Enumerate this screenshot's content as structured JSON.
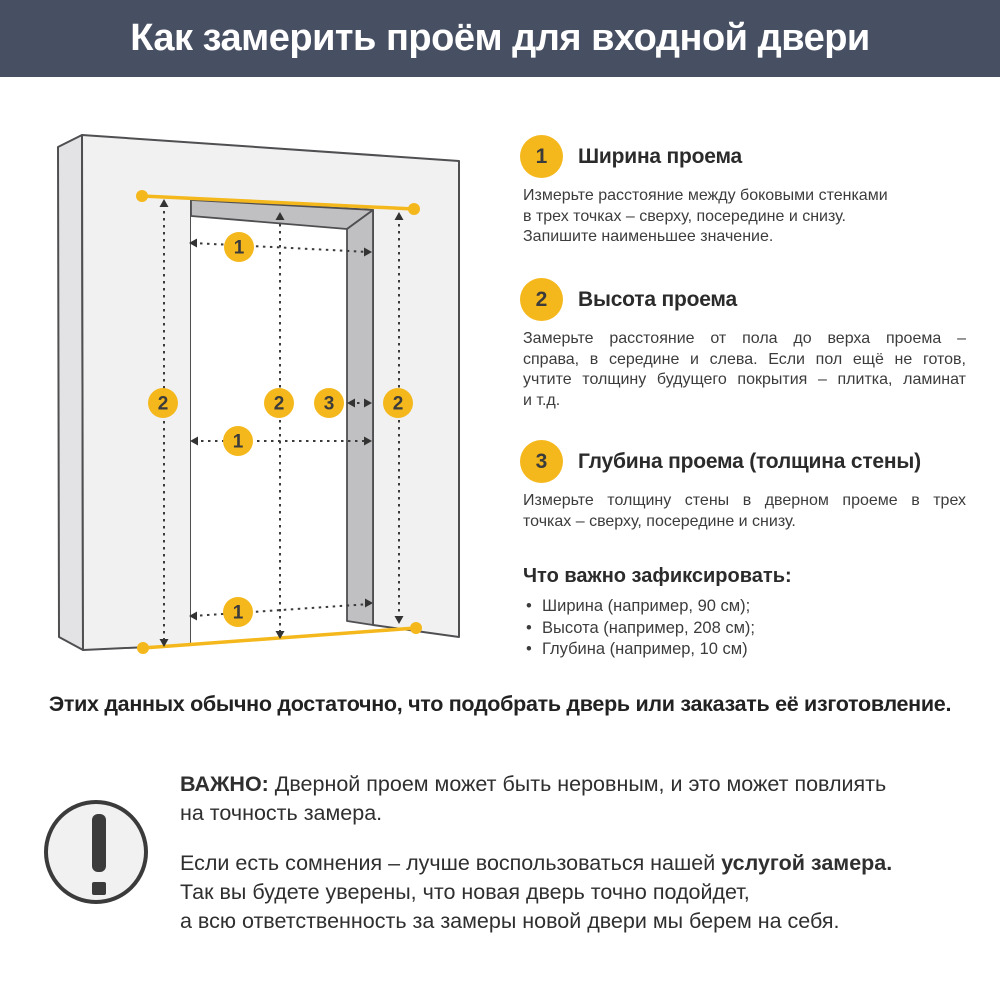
{
  "header": {
    "title": "Как замерить проём для входной двери"
  },
  "diagram": {
    "badge_one": "1",
    "badge_two": "2",
    "badge_three": "3",
    "legend": {
      "1": "ширина проема",
      "2": "высота проема",
      "3": "глубина проема"
    }
  },
  "steps": [
    {
      "num": "1",
      "title": "Ширина проема",
      "lines": [
        "Измерьте расстояние между боковыми стенками",
        "в трех точках – сверху, посередине и снизу.",
        "Запишите наименьшее значение."
      ]
    },
    {
      "num": "2",
      "title": "Высота проема",
      "lines": [
        "Замерьте расстояние от пола до верха проема –",
        "справа, в середине и слева. Если пол ещё не готов,",
        "учтите толщину будущего покрытия – плитка, ламинат",
        "и т.д."
      ]
    },
    {
      "num": "3",
      "title": "Глубина проема (толщина стены)",
      "lines": [
        "Измерьте толщину стены в дверном проеме в трех",
        "точках – сверху, посередине и снизу."
      ]
    }
  ],
  "checklist": {
    "title": "Что важно зафиксировать:",
    "items": [
      "Ширина (например, 90 см);",
      "Высота (например, 208 см);",
      "Глубина (например, 10 см)"
    ]
  },
  "summary": "Этих данных обычно достаточно, что подобрать дверь или заказать её изготовление.",
  "important": {
    "icon": "exclamation-icon",
    "label": "ВАЖНО:",
    "p1": " Дверной проем может быть неровным, и это может повлиять\nна точность замера.",
    "p2_start": "Если есть сомнения – лучше воспользоваться нашей ",
    "p2_bold": "услугой замера.",
    "p2_rest": "\nТак вы будете уверены, что новая дверь точно подойдет,\nа всю ответственность за замеры новой двери мы берем на себя."
  },
  "colors": {
    "header_bg": "#475063",
    "accent_yellow": "#F5B81C",
    "ink": "#333333",
    "badge_text": "#3B3B3B",
    "wall_front": "#F1F1F2",
    "wall_side": "#E3E3E5",
    "wall_reveal": "#C0C0C2",
    "outline": "#4F4F52"
  }
}
